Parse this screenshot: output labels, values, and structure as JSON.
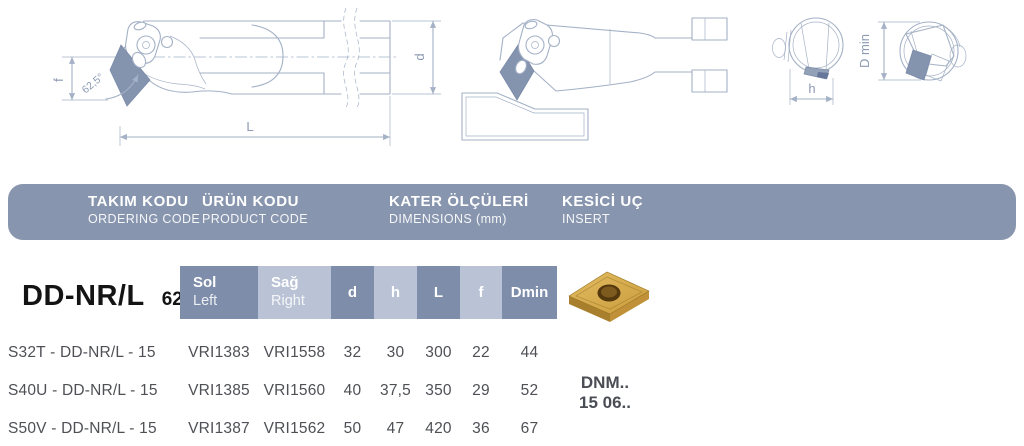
{
  "band": {
    "columns": [
      {
        "title": "TAKIM KODU",
        "subtitle": "ORDERING CODE"
      },
      {
        "title": "ÜRÜN KODU",
        "subtitle": "PRODUCT CODE"
      },
      {
        "title": "KATER ÖLÇÜLERİ",
        "subtitle": "DIMENSIONS (mm)"
      },
      {
        "title": "KESİCİ UÇ",
        "subtitle": "INSERT"
      }
    ]
  },
  "product": {
    "series": "DD-NR/L",
    "angle": "62,5°"
  },
  "table": {
    "side_headers": {
      "sol": {
        "tr": "Sol",
        "en": "Left"
      },
      "sag": {
        "tr": "Sağ",
        "en": "Right"
      }
    },
    "dim_headers": [
      "d",
      "h",
      "L",
      "f",
      "Dmin"
    ],
    "rows": [
      [
        "S32T - DD-NR/L - 15",
        "VRI1383",
        "VRI1558",
        "32",
        "30",
        "300",
        "22",
        "44"
      ],
      [
        "S40U - DD-NR/L - 15",
        "VRI1385",
        "VRI1560",
        "40",
        "37,5",
        "350",
        "29",
        "52"
      ],
      [
        "S50V - DD-NR/L - 15",
        "VRI1387",
        "VRI1562",
        "50",
        "47",
        "420",
        "36",
        "67"
      ]
    ]
  },
  "insert_code": {
    "line1": "DNM..",
    "line2": "15 06.."
  },
  "drawings": {
    "f_label": "f",
    "angle_label": "62,5°",
    "L_label": "L",
    "d_label": "d",
    "h_label": "h",
    "dmin_label": "D min"
  },
  "colors": {
    "band": "#8795AE",
    "cell_dark": "#7E8DA9",
    "cell_light": "#B9C3D5",
    "line": "#A4B1C6",
    "line_text": "#8C9AB1",
    "insert_fill": "#8494AF",
    "insert_stroke": "#7A8BA8",
    "row_text": "#4E5055",
    "title_text": "#141414",
    "code_text": "#4A4E54",
    "tab_fill": "#93A1B8",
    "tab_dark": "#66779A",
    "gold_top_light": "#E3BC62",
    "gold_top_dark": "#C99C3C",
    "gold_side_left": "#A87F2C",
    "gold_side_right": "#C09138",
    "gold_hole": "#54380E",
    "gold_hole_inner": "#7D5A1D"
  }
}
